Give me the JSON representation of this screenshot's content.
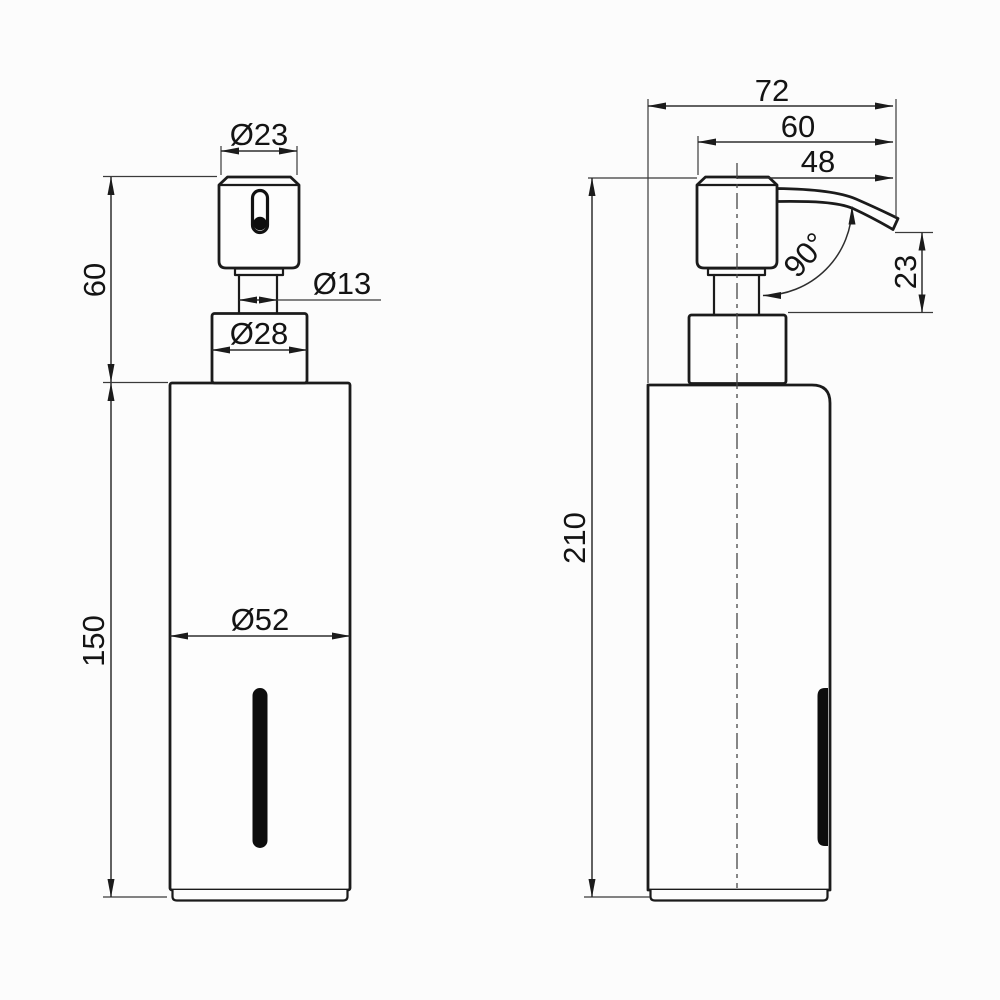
{
  "drawing": {
    "title": "soap dispenser technical drawing, two orthographic views",
    "labels": {
      "front": {
        "head_d": "Ø23",
        "stem_d": "Ø13",
        "collar_d": "Ø28",
        "body_d": "Ø52",
        "pump_h": "60",
        "body_h": "150"
      },
      "side": {
        "depth": "72",
        "reach": "60",
        "spout_proj": "48",
        "angle": "90°",
        "drop": "23",
        "height": "210"
      }
    }
  }
}
